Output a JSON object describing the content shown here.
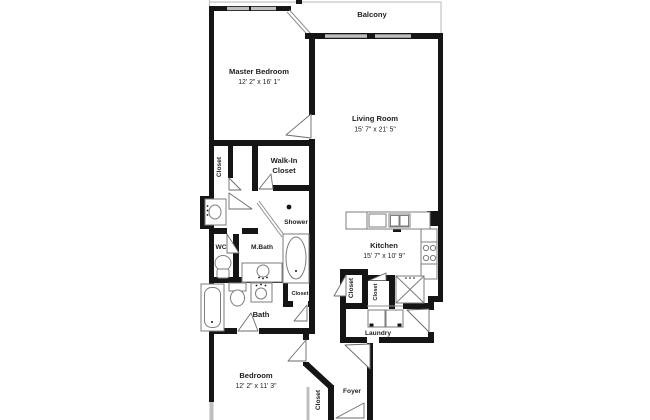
{
  "plan": {
    "type": "apartment-floor-plan",
    "colors": {
      "wall": "#151515",
      "window": "#bfbfbf",
      "fixture": "#7d7d7d",
      "text": "#1f1f1f",
      "background": "#ffffff"
    }
  },
  "rooms": {
    "balcony": {
      "name": "Balcony"
    },
    "master_bedroom": {
      "name": "Master Bedroom",
      "dims": "12' 2\" x 16' 1\""
    },
    "living_room": {
      "name": "Living Room",
      "dims": "15' 7\" x 21' 5\""
    },
    "master_closet": {
      "name": "Closet"
    },
    "walk_in_closet": {
      "name_line1": "Walk-In",
      "name_line2": "Closet"
    },
    "shower": {
      "name": "Shower"
    },
    "wc": {
      "name": "WC"
    },
    "master_bath": {
      "name": "M.Bath"
    },
    "kitchen": {
      "name": "Kitchen",
      "dims": "15' 7\" x 10' 9\""
    },
    "bath": {
      "name": "Bath"
    },
    "bath_closet": {
      "name": "Closet"
    },
    "pantry_closet": {
      "name": "Closet"
    },
    "kitchen_closet": {
      "name": "Closet"
    },
    "laundry": {
      "name": "Laundry"
    },
    "bedroom": {
      "name": "Bedroom",
      "dims": "12' 2\" x 11' 3\""
    },
    "bedroom_closet": {
      "name": "Closet"
    },
    "foyer": {
      "name": "Foyer"
    }
  }
}
